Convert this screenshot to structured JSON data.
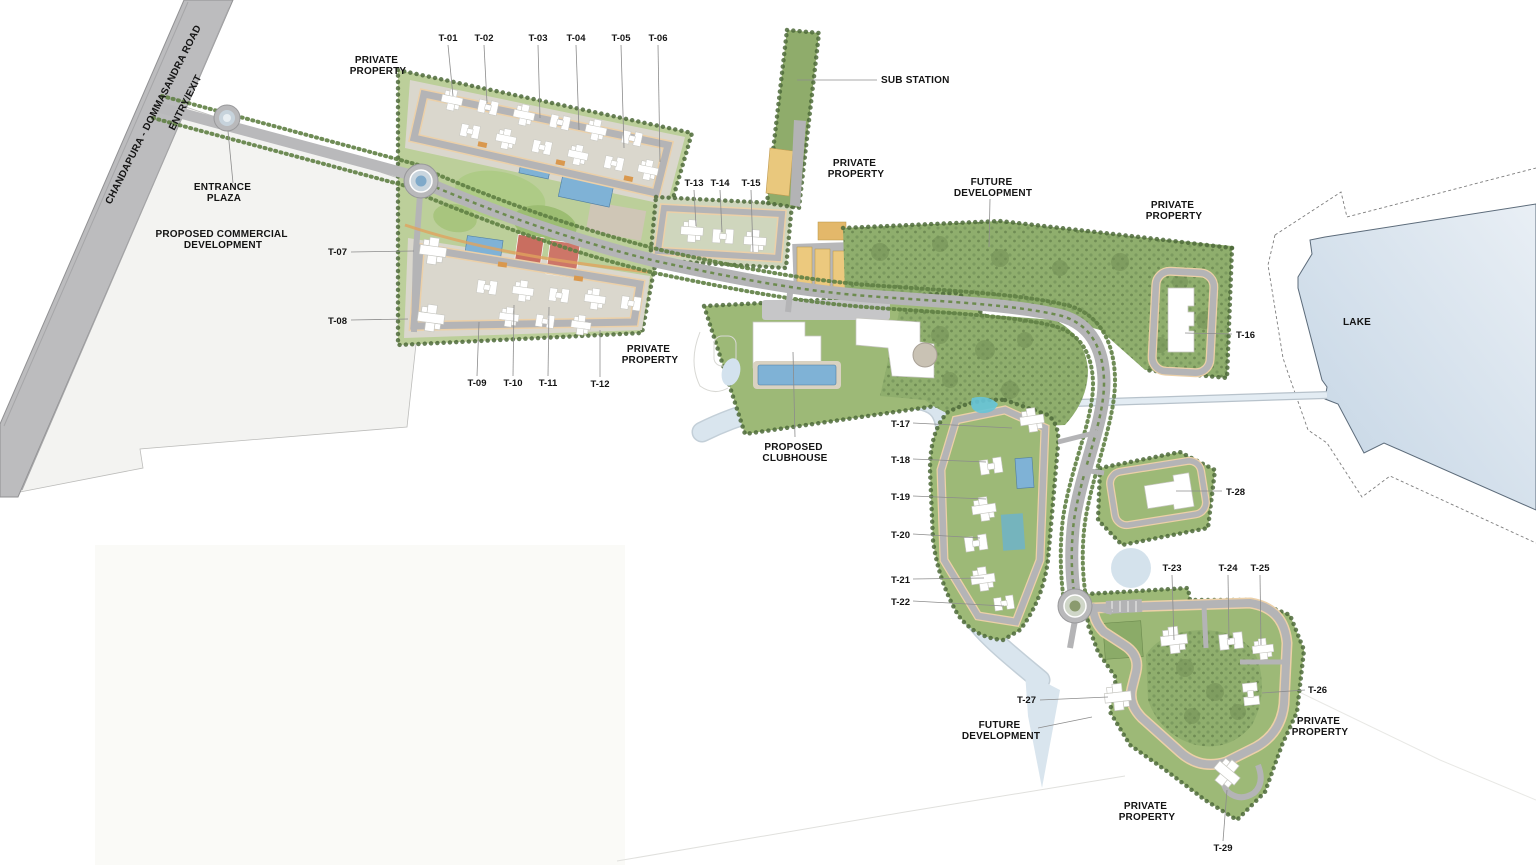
{
  "colors": {
    "road": "#bcbcbe",
    "commercial_parcel": "#f3f3f1",
    "green_band": "#9db977",
    "vegetation": "#8fae6d",
    "tree_border": "#4e6a39",
    "building": "#ffffff",
    "pool": "#7fb2d6",
    "stream": "#d9e5ee",
    "lake_fill": "#cddced",
    "lake_outline": "#5c6b7a",
    "parking_yellow": "#ecc97e",
    "court_red": "#c96e60",
    "path_peach": "#ecd0a8",
    "accent_orange": "#d9984e",
    "label_text": "#141414"
  },
  "labels": {
    "road_name": "CHANDAPURA - DOMMASANDRA ROAD",
    "entry_exit": "ENTRY/EXIT",
    "sub_station": "SUB STATION",
    "lake": "LAKE"
  },
  "areas": {
    "private_property": {
      "line1": "PRIVATE",
      "line2": "PROPERTY"
    },
    "future_development": {
      "line1": "FUTURE",
      "line2": "DEVELOPMENT"
    },
    "entrance_plaza": {
      "line1": "ENTRANCE",
      "line2": "PLAZA"
    },
    "proposed_commercial": {
      "line1": "PROPOSED COMMERCIAL",
      "line2": "DEVELOPMENT"
    },
    "proposed_clubhouse": {
      "line1": "PROPOSED",
      "line2": "CLUBHOUSE"
    }
  },
  "towers": {
    "t01": "T-01",
    "t02": "T-02",
    "t03": "T-03",
    "t04": "T-04",
    "t05": "T-05",
    "t06": "T-06",
    "t07": "T-07",
    "t08": "T-08",
    "t09": "T-09",
    "t10": "T-10",
    "t11": "T-11",
    "t12": "T-12",
    "t13": "T-13",
    "t14": "T-14",
    "t15": "T-15",
    "t16": "T-16",
    "t17": "T-17",
    "t18": "T-18",
    "t19": "T-19",
    "t20": "T-20",
    "t21": "T-21",
    "t22": "T-22",
    "t23": "T-23",
    "t24": "T-24",
    "t25": "T-25",
    "t26": "T-26",
    "t27": "T-27",
    "t28": "T-28",
    "t29": "T-29"
  }
}
